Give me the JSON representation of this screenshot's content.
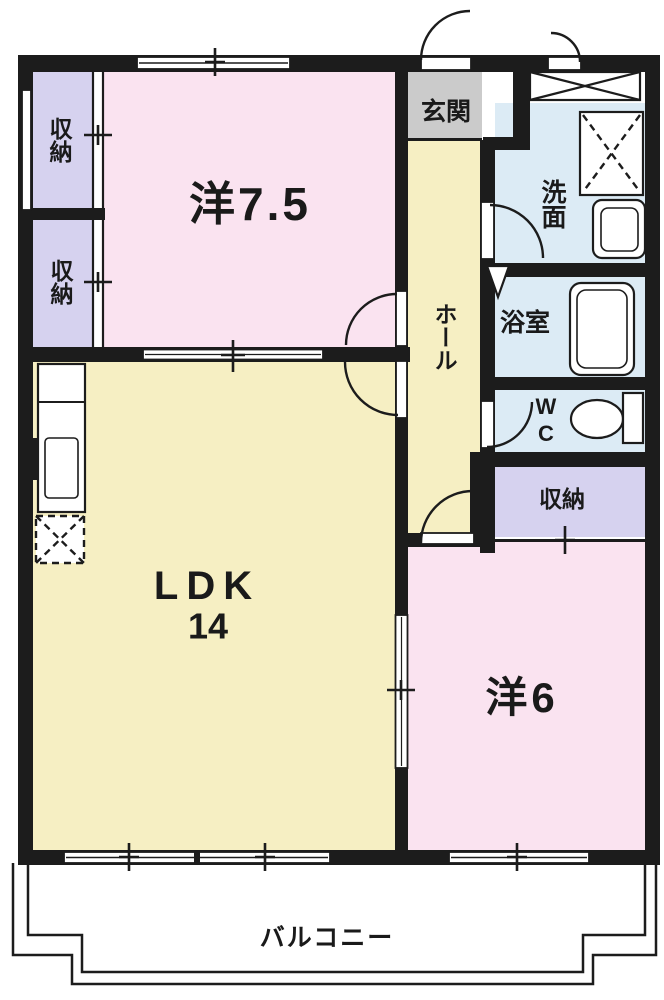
{
  "plan": {
    "type": "apartment-floor-plan",
    "rooms": {
      "western_7_5": {
        "label": "洋7.5"
      },
      "storage_left_top": {
        "label": "収納"
      },
      "storage_left_bottom": {
        "label": "収納"
      },
      "entry": {
        "label": "玄関"
      },
      "hall": {
        "label": "ホール"
      },
      "washroom": {
        "label": "洗面"
      },
      "bathroom": {
        "label": "浴室"
      },
      "wc": {
        "label": "WC"
      },
      "storage_right": {
        "label": "収納"
      },
      "ldk": {
        "label": "LDK",
        "size_tatami": "14"
      },
      "western_6": {
        "label": "洋6"
      },
      "balcony": {
        "label": "バルコニー"
      }
    },
    "colors": {
      "wall": "#1c1c1c",
      "western_room": "#fae3f0",
      "ldk_hall": "#f6efc3",
      "storage": "#d6d2ef",
      "wet_area": "#dcebf5",
      "entry_floor": "#cbcbcb",
      "background": "#ffffff"
    },
    "fixtures": [
      "kitchen-counter",
      "kitchen-sink",
      "refrigerator-space",
      "washing-machine-space",
      "vanity-sink",
      "bathtub",
      "toilet",
      "meter-box"
    ]
  }
}
